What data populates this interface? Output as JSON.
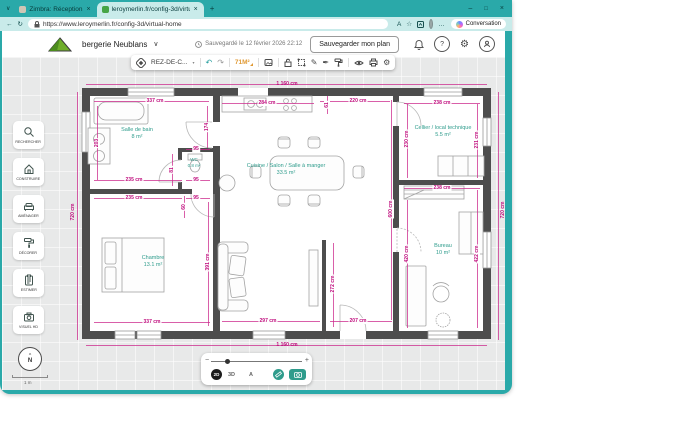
{
  "browser": {
    "tab_search_glyph": "∨",
    "tabs": [
      {
        "label": "Zimbra: Réception"
      },
      {
        "label": "leroymerlin.fr/config-3d/virtual-h..."
      }
    ],
    "new_tab": "+",
    "window_controls": {
      "minimize": "–",
      "maximize": "□",
      "close": "×"
    },
    "tab_close": "×",
    "nav": {
      "back": "←",
      "refresh": "↻"
    },
    "url": "https://www.leroymerlin.fr/config-3d/virtual-home",
    "read_aloud": "A",
    "favorite_star": "☆",
    "more_menu": "…",
    "conversation_label": "Conversation"
  },
  "app_header": {
    "project_name": "bergerie Neublans",
    "project_chevron": "∨",
    "saved_text": "Sauvegardé le 12 février 2026 22:12",
    "save_button_label": "Sauvegarder mon plan",
    "help_glyph": "?"
  },
  "toolbar": {
    "floor_label": "REZ-DE-C...",
    "floor_chevron": "▾",
    "undo": "↶",
    "redo": "↷",
    "area_badge": "71M²",
    "pencil": "✎",
    "pen": "✒",
    "gear": "⚙"
  },
  "sidebar": {
    "items": [
      {
        "label": "RECHERCHER"
      },
      {
        "label": "CONSTRUIRE"
      },
      {
        "label": "AMÉNAGER"
      },
      {
        "label": "DÉCORER"
      },
      {
        "label": "ESTIMER"
      },
      {
        "label": "VISUEL HD"
      }
    ]
  },
  "viewport": {
    "compass_letter": "N",
    "compass_arrow": "^",
    "scale_label": "1 m",
    "zoom_minus": "−",
    "zoom_plus": "+",
    "mode_2d": "2D",
    "mode_3d": "3D",
    "text_toggle": "A"
  },
  "plan": {
    "rooms": [
      {
        "name": "Salle de bain",
        "area": "8 m²",
        "x": 137,
        "y": 134
      },
      {
        "name": "WC",
        "area": "0.8 m²",
        "x": 194,
        "y": 163,
        "small": true
      },
      {
        "name": "Cuisine / Salon / Salle à manger",
        "area": "33.5 m²",
        "x": 286,
        "y": 170
      },
      {
        "name": "Cellier / local technique",
        "area": "5.5 m²",
        "x": 443,
        "y": 132
      },
      {
        "name": "Chambre",
        "area": "13.1 m²",
        "x": 153,
        "y": 262
      },
      {
        "name": "Bureau",
        "area": "10 m²",
        "x": 443,
        "y": 250
      }
    ],
    "dim_labels": [
      {
        "t": "1 160 cm",
        "x": 287,
        "y": 84,
        "outside": true
      },
      {
        "t": "1 160 cm",
        "x": 287,
        "y": 345,
        "outside": true
      },
      {
        "t": "720 cm",
        "x": 73,
        "y": 212,
        "v": true,
        "outside": true
      },
      {
        "t": "720 cm",
        "x": 503,
        "y": 210,
        "v": true,
        "outside": true
      },
      {
        "t": "337 cm",
        "x": 155,
        "y": 101
      },
      {
        "t": "284 cm",
        "x": 267,
        "y": 103
      },
      {
        "t": "220 cm",
        "x": 358,
        "y": 101
      },
      {
        "t": "238 cm",
        "x": 442,
        "y": 103
      },
      {
        "t": "61",
        "x": 327,
        "y": 105,
        "v": true
      },
      {
        "t": "174",
        "x": 207,
        "y": 127,
        "v": true
      },
      {
        "t": "203",
        "x": 97,
        "y": 143,
        "v": true
      },
      {
        "t": "95",
        "x": 196,
        "y": 149
      },
      {
        "t": "81",
        "x": 172,
        "y": 170,
        "v": true
      },
      {
        "t": "95",
        "x": 196,
        "y": 180
      },
      {
        "t": "235 cm",
        "x": 134,
        "y": 180
      },
      {
        "t": "235 cm",
        "x": 134,
        "y": 198
      },
      {
        "t": "95",
        "x": 196,
        "y": 198
      },
      {
        "t": "60",
        "x": 184,
        "y": 207,
        "v": true
      },
      {
        "t": "230 cm",
        "x": 407,
        "y": 139,
        "v": true
      },
      {
        "t": "231 cm",
        "x": 477,
        "y": 140,
        "v": true
      },
      {
        "t": "238 cm",
        "x": 442,
        "y": 188
      },
      {
        "t": "600 cm",
        "x": 391,
        "y": 209,
        "v": true
      },
      {
        "t": "391 cm",
        "x": 208,
        "y": 262,
        "v": true
      },
      {
        "t": "272 cm",
        "x": 333,
        "y": 284,
        "v": true
      },
      {
        "t": "420 cm",
        "x": 407,
        "y": 254,
        "v": true
      },
      {
        "t": "422 cm",
        "x": 477,
        "y": 254,
        "v": true
      },
      {
        "t": "337 cm",
        "x": 152,
        "y": 322
      },
      {
        "t": "297 cm",
        "x": 268,
        "y": 321
      },
      {
        "t": "207 cm",
        "x": 358,
        "y": 321
      }
    ],
    "dim_lines": [
      {
        "x": 86,
        "y": 84,
        "w": 401,
        "h": 1
      },
      {
        "x": 86,
        "y": 345,
        "w": 401,
        "h": 1
      },
      {
        "x": 77,
        "y": 92,
        "w": 1,
        "h": 248
      },
      {
        "x": 498,
        "y": 92,
        "w": 1,
        "h": 248
      },
      {
        "x": 94,
        "y": 101,
        "w": 115,
        "h": 1
      },
      {
        "x": 222,
        "y": 103,
        "w": 92,
        "h": 1
      },
      {
        "x": 320,
        "y": 101,
        "w": 70,
        "h": 1
      },
      {
        "x": 404,
        "y": 103,
        "w": 76,
        "h": 1
      },
      {
        "x": 186,
        "y": 149,
        "w": 24,
        "h": 1
      },
      {
        "x": 186,
        "y": 180,
        "w": 24,
        "h": 1
      },
      {
        "x": 94,
        "y": 180,
        "w": 88,
        "h": 1
      },
      {
        "x": 94,
        "y": 198,
        "w": 88,
        "h": 1
      },
      {
        "x": 186,
        "y": 198,
        "w": 24,
        "h": 1
      },
      {
        "x": 404,
        "y": 188,
        "w": 76,
        "h": 1
      },
      {
        "x": 94,
        "y": 322,
        "w": 116,
        "h": 1
      },
      {
        "x": 222,
        "y": 321,
        "w": 98,
        "h": 1
      },
      {
        "x": 330,
        "y": 321,
        "w": 62,
        "h": 1
      },
      {
        "x": 97,
        "y": 106,
        "w": 1,
        "h": 74
      },
      {
        "x": 207,
        "y": 106,
        "w": 1,
        "h": 42
      },
      {
        "x": 172,
        "y": 154,
        "w": 1,
        "h": 32
      },
      {
        "x": 184,
        "y": 196,
        "w": 1,
        "h": 22
      },
      {
        "x": 327,
        "y": 96,
        "w": 1,
        "h": 18
      },
      {
        "x": 407,
        "y": 104,
        "w": 1,
        "h": 74
      },
      {
        "x": 477,
        "y": 104,
        "w": 1,
        "h": 74
      },
      {
        "x": 407,
        "y": 200,
        "w": 1,
        "h": 128
      },
      {
        "x": 477,
        "y": 190,
        "w": 1,
        "h": 138
      },
      {
        "x": 391,
        "y": 100,
        "w": 1,
        "h": 220
      },
      {
        "x": 208,
        "y": 202,
        "w": 1,
        "h": 124
      },
      {
        "x": 333,
        "y": 243,
        "w": 1,
        "h": 84
      }
    ]
  }
}
